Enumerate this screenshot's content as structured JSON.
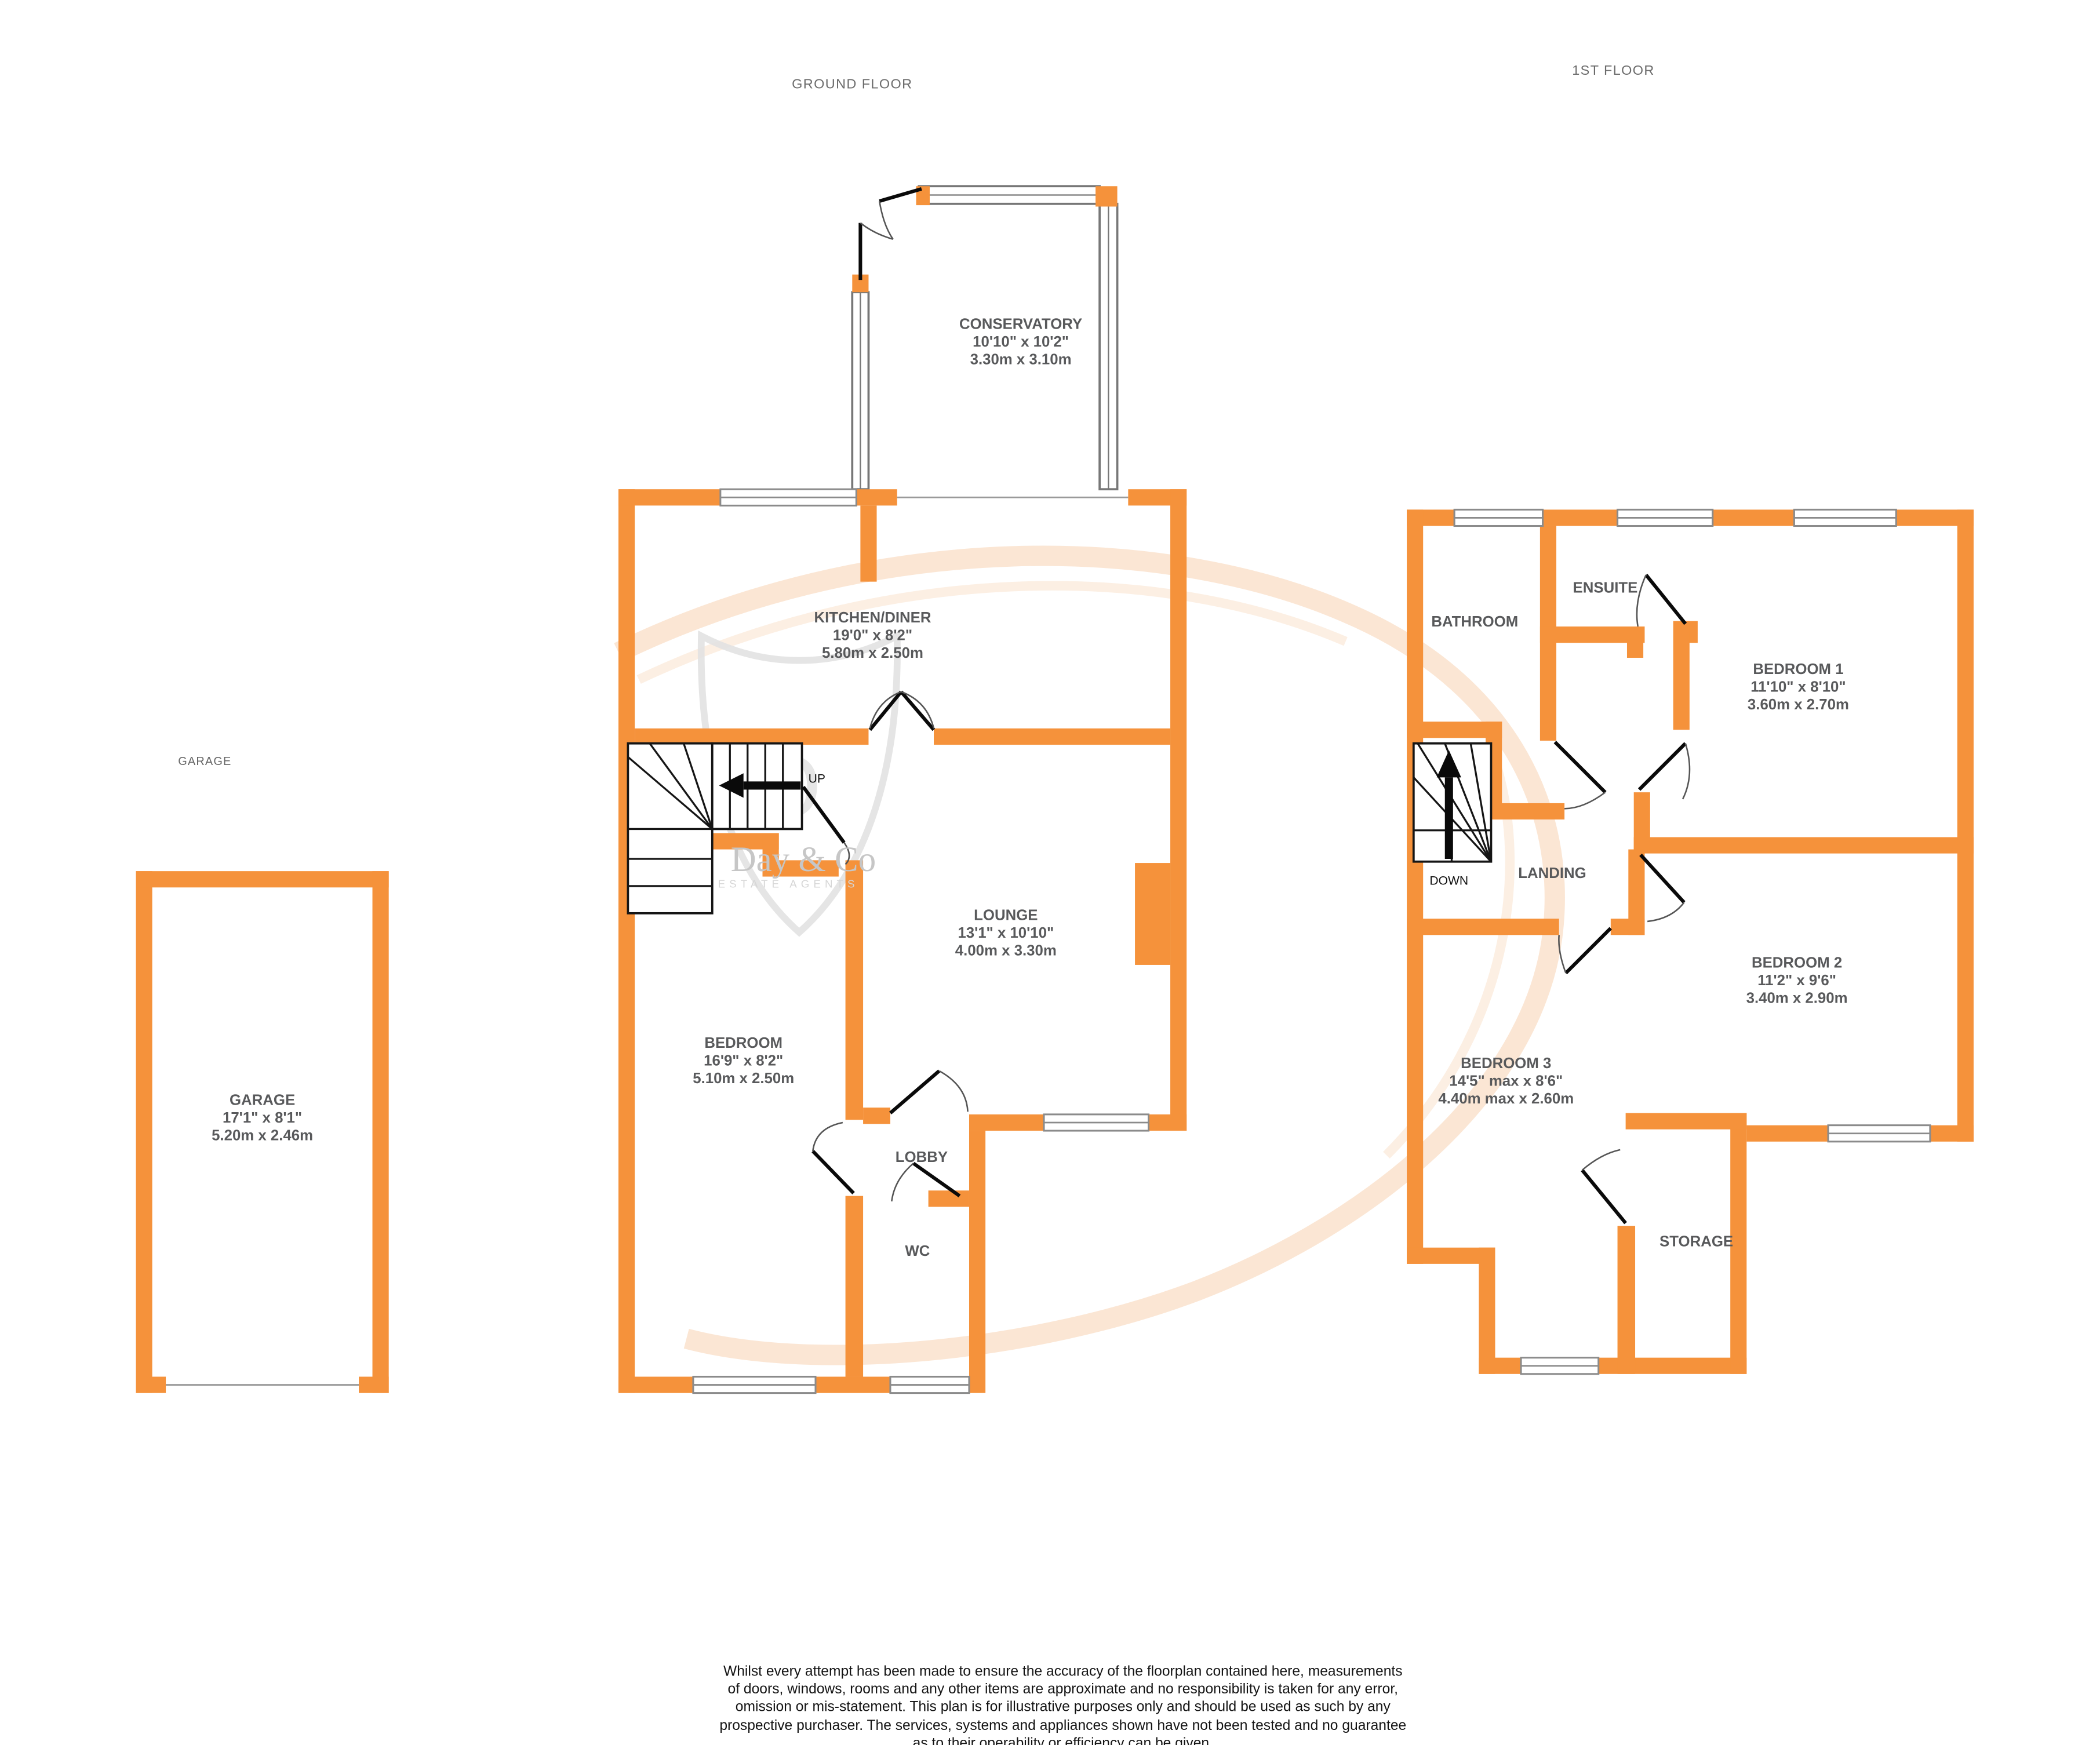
{
  "floor_titles": {
    "ground": "GROUND FLOOR",
    "first": "1ST FLOOR"
  },
  "garage_caption": "GARAGE",
  "rooms": {
    "conservatory": {
      "name": "CONSERVATORY",
      "dims_ft": "10'10\"  x 10'2\"",
      "dims_m": "3.30m  x 3.10m"
    },
    "kitchen_diner": {
      "name": "KITCHEN/DINER",
      "dims_ft": "19'0\"  x 8'2\"",
      "dims_m": "5.80m  x 2.50m"
    },
    "lounge": {
      "name": "LOUNGE",
      "dims_ft": "13'1\"  x 10'10\"",
      "dims_m": "4.00m  x 3.30m"
    },
    "bedroom_gf": {
      "name": "BEDROOM",
      "dims_ft": "16'9\"  x 8'2\"",
      "dims_m": "5.10m  x 2.50m"
    },
    "lobby": {
      "name": "LOBBY"
    },
    "wc": {
      "name": "WC"
    },
    "garage": {
      "name": "GARAGE",
      "dims_ft": "17'1\"  x 8'1\"",
      "dims_m": "5.20m  x 2.46m"
    },
    "bathroom": {
      "name": "BATHROOM"
    },
    "ensuite": {
      "name": "ENSUITE"
    },
    "bedroom1": {
      "name": "BEDROOM 1",
      "dims_ft": "11'10\"  x 8'10\"",
      "dims_m": "3.60m  x 2.70m"
    },
    "landing": {
      "name": "LANDING"
    },
    "bedroom2": {
      "name": "BEDROOM 2",
      "dims_ft": "11'2\"  x 9'6\"",
      "dims_m": "3.40m  x 2.90m"
    },
    "bedroom3": {
      "name": "BEDROOM 3",
      "dims_ft": "14'5\" max x 8'6\"",
      "dims_m": "4.40m max x 2.60m"
    },
    "storage": {
      "name": "STORAGE"
    }
  },
  "stairs": {
    "up_label": "UP",
    "down_label": "DOWN"
  },
  "watermark": {
    "monogram": "D",
    "line1": "Day & Co",
    "line2": "ESTATE AGENTS"
  },
  "disclaimer": {
    "lines": [
      "Whilst every attempt has been made to ensure the accuracy of the floorplan contained here, measurements",
      "of doors, windows, rooms and any other items are approximate and no responsibility is taken for any error,",
      "omission or mis-statement. This plan is for illustrative purposes only and should be used as such by any",
      "prospective purchaser. The services, systems and appliances shown have not been tested and no guarantee",
      "as to their operability or efficiency can be given.",
      "Made with Metropix ©2026"
    ]
  },
  "colors": {
    "wall_orange": "#F5923B",
    "room_text": "#58595B",
    "caption_text": "#6B6B6B",
    "watermark_orange": "#FAE2CC",
    "watermark_gray": "#C6C6C6"
  }
}
